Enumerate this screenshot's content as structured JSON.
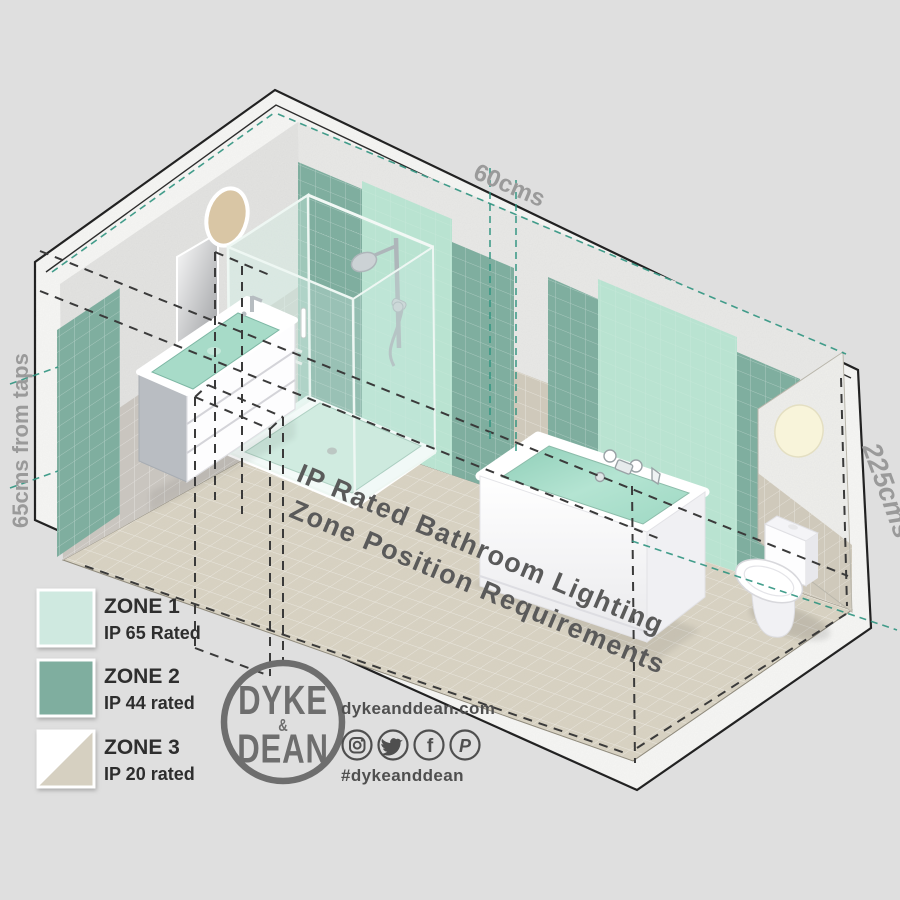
{
  "title": {
    "line1": "IP Rated Bathroom Lighting",
    "line2": "Zone Position Requirements"
  },
  "dimensions": {
    "top": "60cms",
    "right": "225cms",
    "left": "65cms from taps"
  },
  "legend": {
    "zones": [
      {
        "label": "ZONE 1",
        "rating": "IP 65 Rated",
        "color": "#cfe9e0"
      },
      {
        "label": "ZONE 2",
        "rating": "IP 44 rated",
        "color": "#7fae9f"
      },
      {
        "label": "ZONE 3",
        "rating": "IP 20 rated",
        "color": "#d6d0c1"
      }
    ]
  },
  "brand": {
    "logo_top": "DYKE",
    "logo_amp": "&",
    "logo_bottom": "DEAN",
    "website": "dykeanddean.com",
    "hashtag": "#dykeanddean",
    "facebook_glyph": "f",
    "pinterest_glyph": "P",
    "social_icons": [
      "instagram-icon",
      "twitter-icon",
      "facebook-icon",
      "pinterest-icon"
    ]
  },
  "colors": {
    "background": "#dfdfdf",
    "zone1_mint": "#b9e3d1",
    "zone2_teal": "#7fae9f",
    "zone3_beige": "#d6d0c1",
    "floor": "#d8d2c2",
    "dashed_zone_line": "#3a3a3a",
    "teal_dimension_line": "#2f9480"
  }
}
